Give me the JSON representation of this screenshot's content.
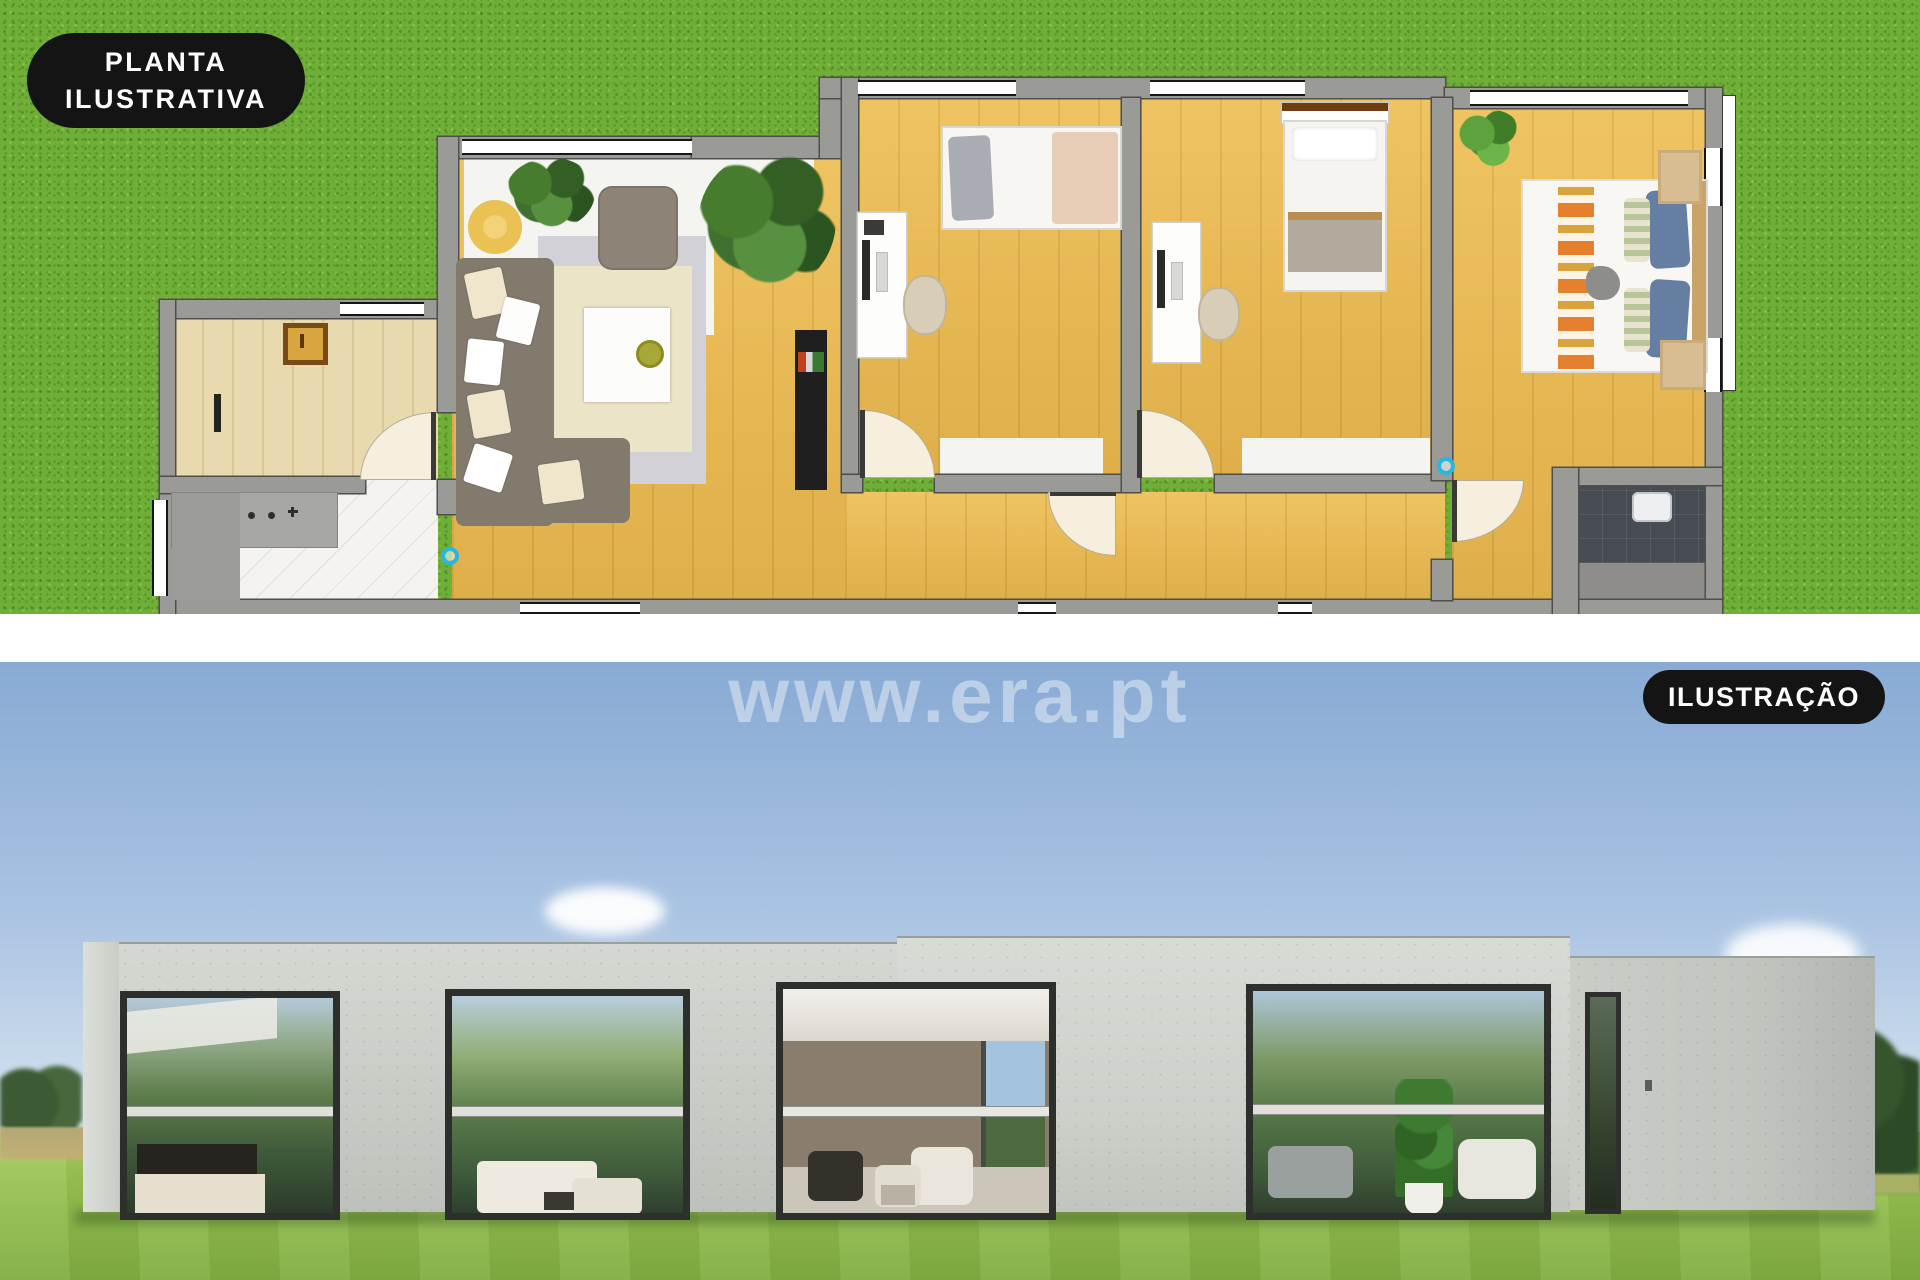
{
  "plan_badge": {
    "line1": "PLANTA",
    "line2": "ILUSTRATIVA"
  },
  "photo_badge": {
    "label": "ILUSTRAÇÃO"
  },
  "watermark": {
    "text": "www.era.pt"
  },
  "palette": {
    "badge_bg": "#141414",
    "badge_text": "#ffffff",
    "grass": "#6fae37",
    "wall_gray": "#9a9a96",
    "wood_floor": "#eab84d",
    "entry_floor": "#e9d9ae",
    "marble_floor": "#f4f3f0",
    "dark_bath_tile": "#474c52",
    "sky_top": "#88aad4",
    "sky_horizon": "#dfe7ee",
    "lawn": "#8fbb4b",
    "concrete": "#cdd0ca",
    "window_frame": "#2c2f2c",
    "door_marker": "#2ab7dc",
    "watermark_color": "rgba(255,255,255,0.42)"
  }
}
